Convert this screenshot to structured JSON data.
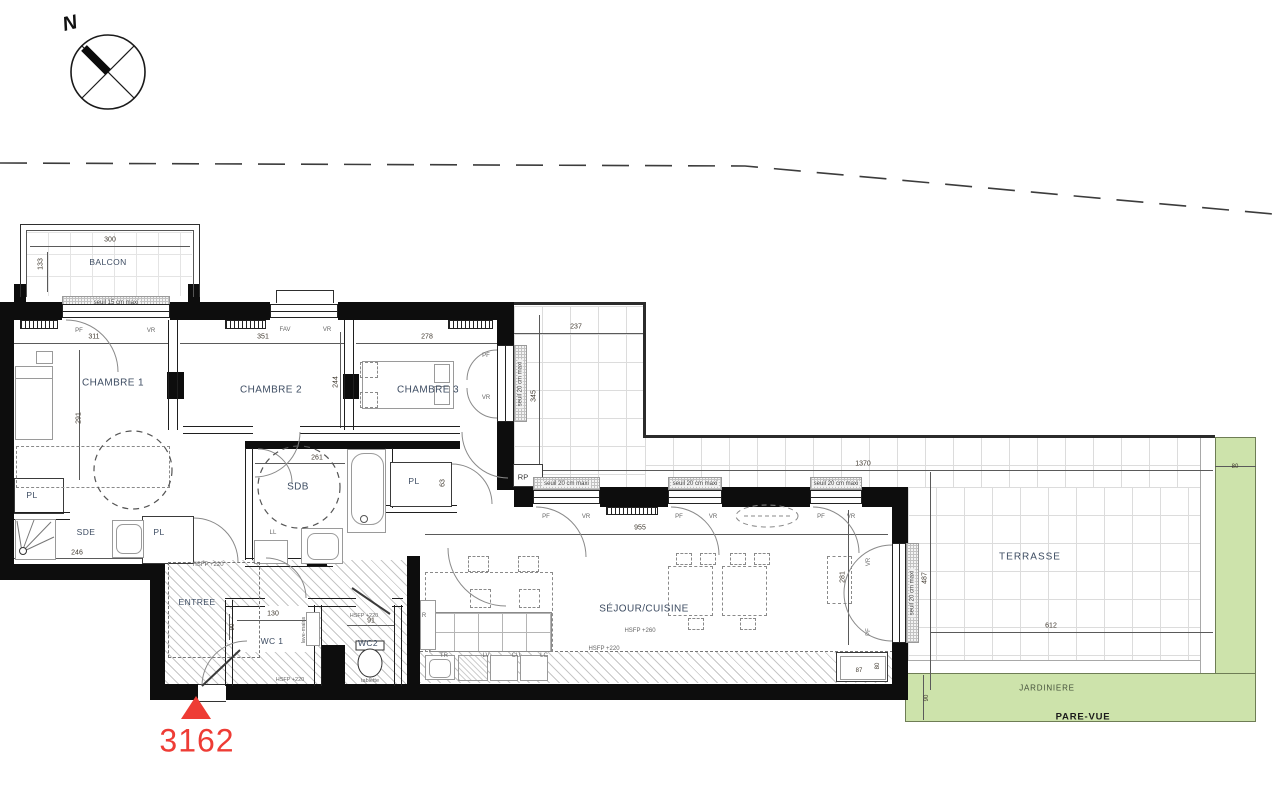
{
  "lot": {
    "number": "3162"
  },
  "compass": {
    "north": "N"
  },
  "rooms": {
    "balcon": "BALCON",
    "chambre1": "CHAMBRE 1",
    "chambre2": "CHAMBRE 2",
    "chambre3": "CHAMBRE 3",
    "sdb": "SDB",
    "sde": "SDE",
    "entree": "ENTREE",
    "wc1": "WC 1",
    "wc2": "WC2",
    "sejour": "SÉJOUR/CUISINE",
    "terrasse": "TERRASSE",
    "jardiniere": "JARDINIERE",
    "pare_vue": "PARE-VUE",
    "pl": "PL",
    "rp": "RP"
  },
  "openings": {
    "pf": "PF",
    "vr": "VR",
    "fav": "FAV"
  },
  "equipment": {
    "ll": "LL",
    "r": "R",
    "tr": "TR",
    "lv": "LV",
    "cu": "CU",
    "lc": "LC",
    "lave_mains": "lave-mains",
    "tablette": "tablette"
  },
  "notes": {
    "seuil15": "seuil 15 cm maxi",
    "seuil20": "seuil 20 cm maxi",
    "hsfp220": "HSFP +220",
    "hsfp260": "HSFP +260"
  },
  "dims": {
    "balcon_w": "300",
    "balcon_d": "133",
    "ch1_w": "311",
    "ch1_d": "291",
    "ch2_w": "351",
    "ch2_d": "244",
    "ch3_w": "278",
    "terr_top_w": "237",
    "terr_top_d": "345",
    "sdb_w": "261",
    "pl_d": "63",
    "sde_w": "246",
    "wc1_w": "130",
    "wc1_d": "90",
    "wc2_w": "91",
    "sejour_w": "955",
    "sejour_d": "281",
    "corner_w": "87",
    "corner_d": "80",
    "terr_w": "1370",
    "terr_d": "487",
    "terr_low_w": "612",
    "jard_w": "80",
    "jard_d": "90"
  },
  "colors": {
    "jardiniere": "#cde3ab",
    "lot": "#ee3c35",
    "ink": "#3d4c62"
  }
}
